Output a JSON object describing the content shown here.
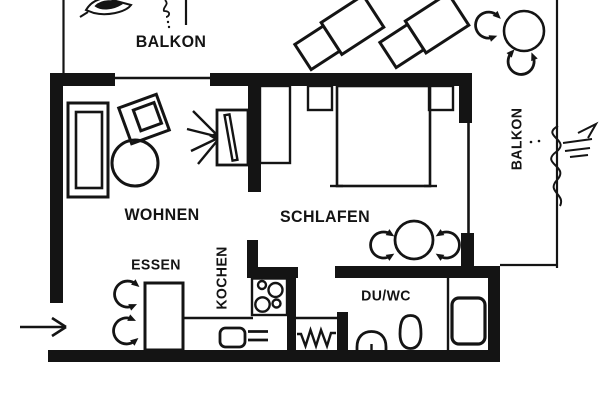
{
  "colors": {
    "ink": "#141414",
    "paper": "#ffffff"
  },
  "labels": {
    "balcony_top": "BALKON",
    "balcony_right": "BALKON",
    "living_room": "WOHNEN",
    "bedroom": "SCHLAFEN",
    "dining_area": "ESSEN",
    "kitchen": "KOCHEN",
    "bathroom": "DU/WC"
  },
  "icons": {
    "entrance_arrow": "right-arrow",
    "chair_symbol": "curved-arrow-chair",
    "radiator_symbol": "zigzag-radiator"
  }
}
